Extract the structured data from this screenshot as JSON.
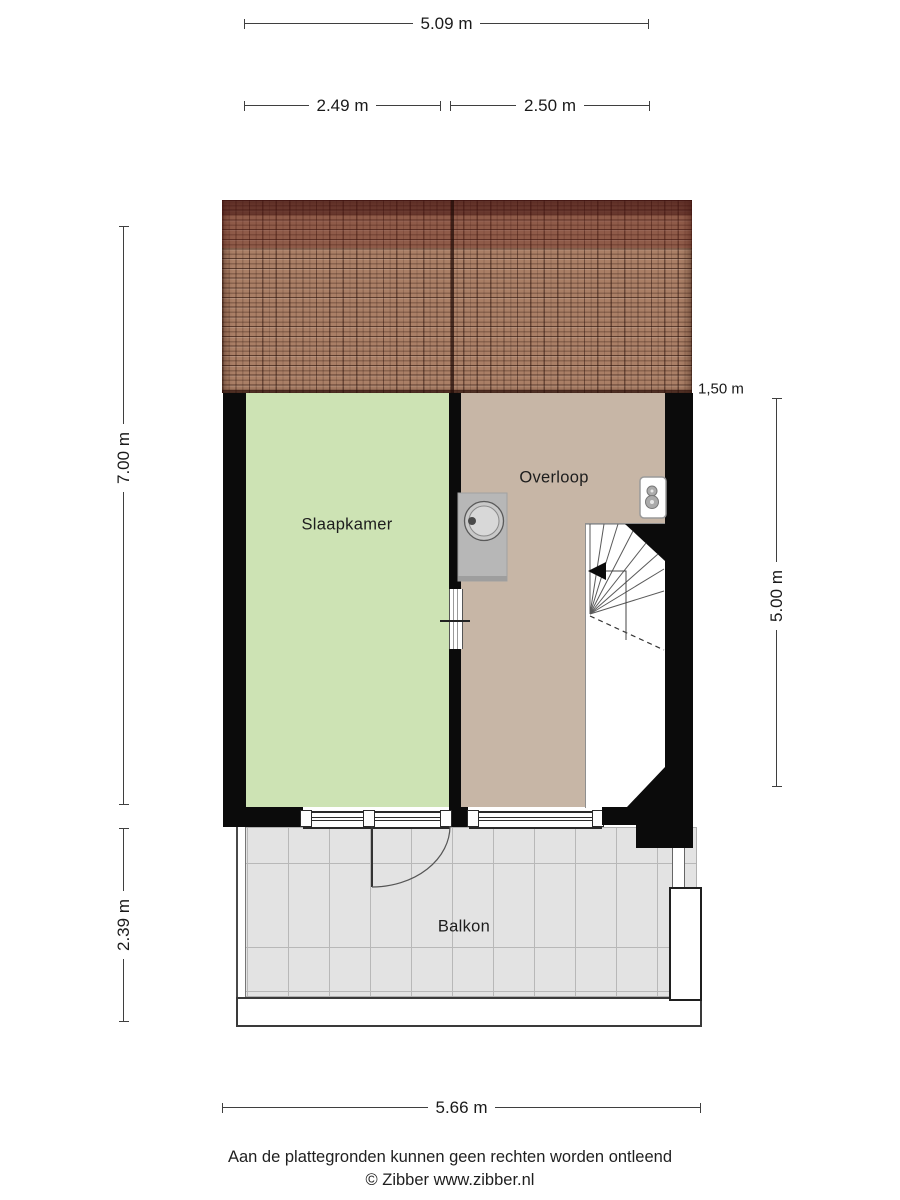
{
  "plan_title": "floor-plan-second-floor",
  "rooms": {
    "bedroom": {
      "label": "Slaapkamer",
      "fill": "#cde3b4"
    },
    "landing": {
      "label": "Overloop",
      "fill": "#c7b6a6"
    },
    "balcony": {
      "label": "Balkon",
      "fill": "#e3e3e3"
    }
  },
  "dimensions": {
    "top_total": "5.09 m",
    "top_left": "2.49 m",
    "top_right": "2.50 m",
    "side_left_upper": "7.00 m",
    "side_left_lower": "2.39 m",
    "knee_wall": "1,50 m",
    "side_right": "5.00 m",
    "bottom_total": "5.66 m"
  },
  "icons": {
    "sink": "sink-icon",
    "ventilation": "ventilation-unit-icon",
    "stairs": "stairs-icon",
    "stairs_arrow": "stairs-direction-arrow-icon",
    "door_swing": "door-swing-icon"
  },
  "footer": {
    "disclaimer": "Aan de plattegronden kunnen geen rechten worden ontleend",
    "copyright": "© Zibber www.zibber.nl"
  },
  "colors": {
    "wall": "#0b0b0b",
    "roof_base": "#aa7f66",
    "roof_ridge": "#6b3a30",
    "bedroom_fill": "#cde3b4",
    "landing_fill": "#c7b6a6",
    "balcony_fill": "#e3e3e3",
    "dimension_line": "#3f3f3f",
    "text": "#1a1a1a"
  }
}
